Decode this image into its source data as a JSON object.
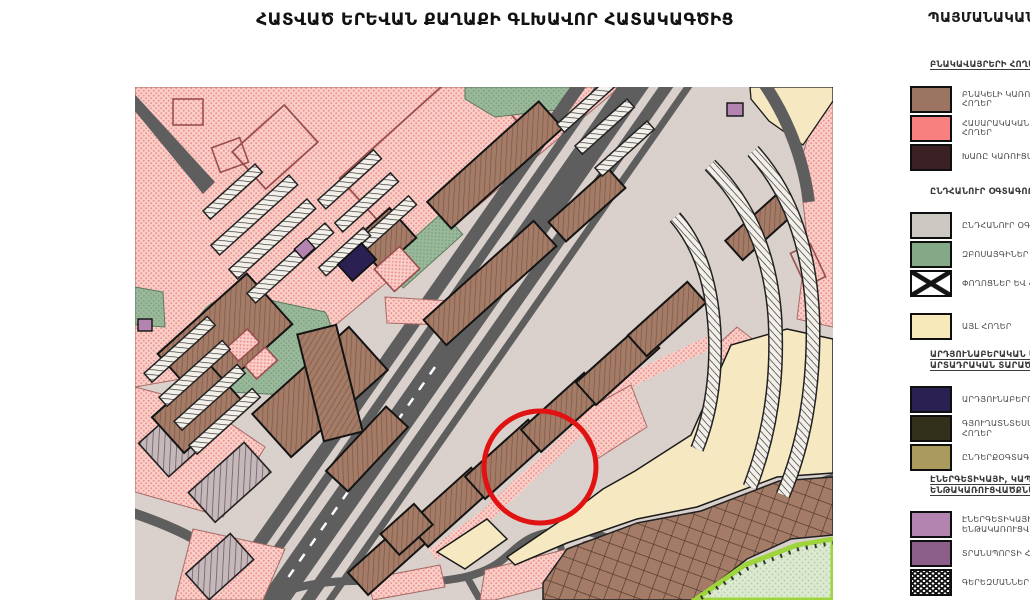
{
  "title": "ՀԱՏՎԱԾ ԵՐԵՎԱՆ ՔԱՂԱՔԻ ԳԼԽԱՎՈՐ ՀԱՏԱԿԱԳԾԻՑ",
  "legend": {
    "title": "ՊԱՅՄԱՆԱԿԱՆ ՆՇԱՆՆԵՐ",
    "groups": [
      {
        "heading": {
          "lines": [
            "ԲՆԱԿԱՎԱՅՐԵՐԻ ՀՈՂԵՐ"
          ],
          "underline": true
        },
        "items": [
          {
            "key": "residential",
            "swatch": {
              "type": "color",
              "color": "#9b7462"
            },
            "lines": [
              "ԲՆԱԿԵԼԻ ԿԱՌՈՒՑԱՊԱՏՄԱՆ",
              "ՀՈՂԵՐ"
            ]
          },
          {
            "key": "public",
            "swatch": {
              "type": "color",
              "color": "#f8807f"
            },
            "lines": [
              "ՀԱՍԱՐԱԿԱԿԱՆ ԿԱՌՈՒՑԱՊԱՏՄԱՆ",
              "ՀՈՂԵՐ"
            ]
          },
          {
            "key": "mixed",
            "swatch": {
              "type": "color",
              "color": "#3a2023"
            },
            "lines": [
              "ԽԱՌԸ ԿԱՌՈՒՑԱՊԱՏՄԱՆ ՀՈՂԵՐ"
            ]
          }
        ]
      },
      {
        "heading": {
          "lines": [
            "ԸՆԴՀԱՆՈՒՐ ՕԳՏԱԳՈՐԾՄԱՆ ՀՈՂԵՐ"
          ],
          "underline": false
        },
        "items": [
          {
            "key": "common-use",
            "swatch": {
              "type": "color",
              "color": "#cbc7c1"
            },
            "lines": [
              "ԸՆԴՀԱՆՈՒՐ ՕԳՏԱԳՈՐԾՄԱՆ ՀՈՂԵՐ"
            ]
          },
          {
            "key": "parks",
            "swatch": {
              "type": "color",
              "color": "#85a887"
            },
            "lines": [
              "ԶԲՈՍԱՅԳԻՆԵՐ"
            ]
          },
          {
            "key": "streets-squares",
            "swatch": {
              "type": "x-pattern",
              "color": "#ffffff"
            },
            "lines": [
              "ՓՈՂՈՑՆԵՐ ԵՎ ՀՐԱՊԱՐԱԿՆԵՐ"
            ]
          }
        ]
      },
      {
        "items": [
          {
            "key": "other-lands",
            "swatch": {
              "type": "color",
              "color": "#f8e9bb"
            },
            "lines": [
              "ԱՅԼ ՀՈՂԵՐ"
            ]
          }
        ]
      },
      {
        "heading": {
          "lines": [
            "ԱՐԴՅՈՒՆԱԲԵՐԱԿԱՆ ԵՎ",
            "ԱՐՏԱԴՐԱԿԱՆ ՏԱՐԱԾՔՆԵՐ"
          ],
          "underline": true
        },
        "items": [
          {
            "key": "industrial",
            "swatch": {
              "type": "color",
              "color": "#2a2052"
            },
            "lines": [
              "ԱՐԴՅՈՒՆԱԲԵՐՈՒԹՅԱՆ ՀՈՂԵՐ"
            ]
          },
          {
            "key": "agricultural",
            "swatch": {
              "type": "color",
              "color": "#32301b"
            },
            "lines": [
              "ԳՅՈՒՂԱՏՆՏԵՍԱԿԱՆ ՆՇԱՆԱԿՈՒԹՅԱՆ",
              "ՀՈՂԵՐ"
            ]
          },
          {
            "key": "subsoil-use",
            "swatch": {
              "type": "color",
              "color": "#aa9a5d"
            },
            "lines": [
              "ԸՆԴԵՐՔՕԳՏԱԳՈՐԾՄԱՆ ՀՈՂԵՐ"
            ]
          }
        ]
      },
      {
        "heading": {
          "lines": [
            "ԷՆԵՐԳԵՏԻԿԱՅԻ, ԿԱՊԻ",
            "ԵՆԹԱԿԱՌՈՒՑՎԱԾՔՆԵՐԻ ՀՈՂԵՐ"
          ],
          "underline": true
        },
        "items": [
          {
            "key": "energy-infrastructure",
            "swatch": {
              "type": "color",
              "color": "#b384b0"
            },
            "lines": [
              "ԷՆԵՐԳԵՏԻԿԱՅԻ ԵՎ ԿԱՊԻ",
              "ԵՆԹԱԿԱՌՈՒՑՎԱԾՔՆԵՐ"
            ]
          },
          {
            "key": "transport",
            "swatch": {
              "type": "color",
              "color": "#8b5f89"
            },
            "lines": [
              "ՏՐԱՆՍՊՈՐՏԻ ՀՈՂԵՐ"
            ]
          },
          {
            "key": "cemeteries",
            "swatch": {
              "type": "dot-pattern",
              "color": "#131313"
            },
            "lines": [
              "ԳԵՐԵԶՄԱՆՆԵՐ"
            ]
          }
        ]
      }
    ]
  },
  "map": {
    "annotation": {
      "type": "circle-highlight",
      "color": "#e11212"
    },
    "colors": {
      "base": "#d8d1cc",
      "base_hatch": "#e2cac6",
      "pink_bg": "#f9cfca",
      "pink_dot": "#ef928c",
      "brown": "#a37b66",
      "brown_line": "#7d5846",
      "green": "#9ab89b",
      "green_dot": "#7ca37d",
      "cream": "#f6e9c2",
      "navy": "#2a2052",
      "purple": "#b384b0",
      "road": "#5e5e5e",
      "lime": "#9ed43c",
      "annotation": "#e11212"
    }
  }
}
